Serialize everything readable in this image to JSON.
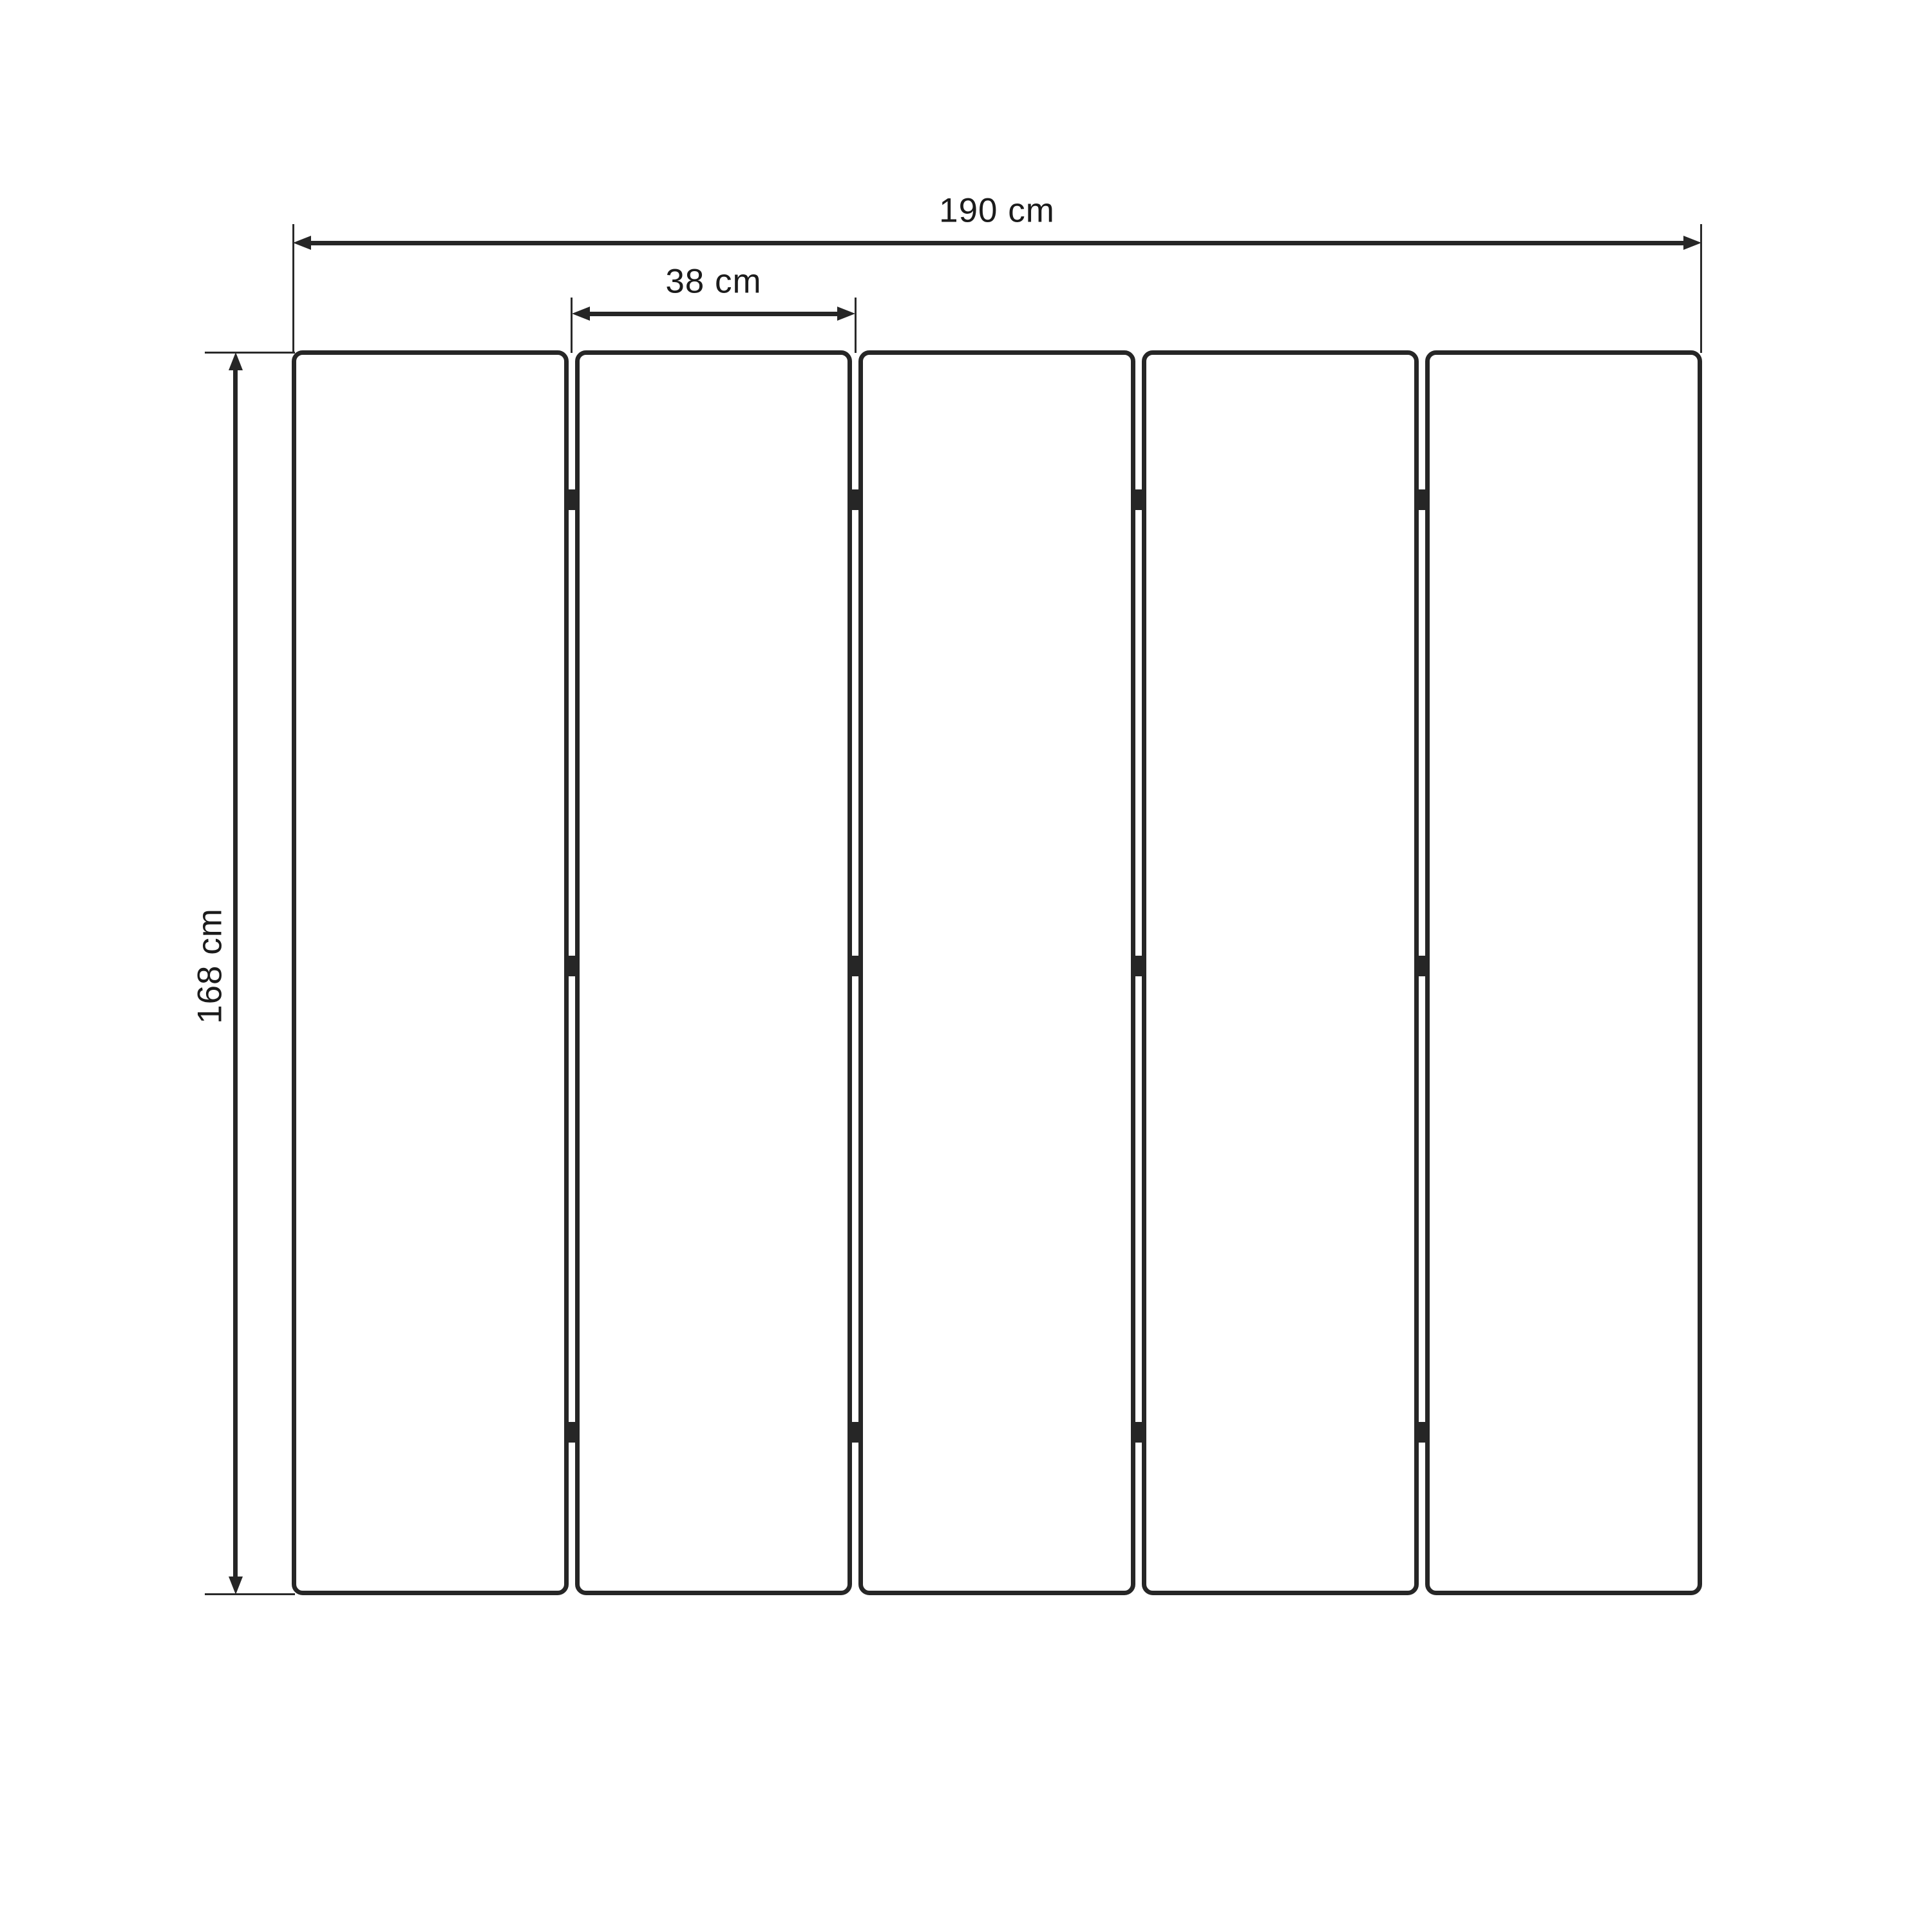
{
  "diagram": {
    "kind": "dimension-drawing",
    "subject": "five-panel-folding-screen",
    "dimensions": {
      "total_width": {
        "label": "190 cm",
        "value": 190,
        "unit": "cm"
      },
      "panel_width": {
        "label": "38 cm",
        "value": 38,
        "unit": "cm"
      },
      "height": {
        "label": "168 cm",
        "value": 168,
        "unit": "cm"
      }
    },
    "panel_count": 5,
    "hinge_gaps": 4,
    "hinges_per_gap": 3,
    "colors": {
      "stroke": "#262626",
      "text": "#1b1b1b",
      "background": "#ffffff"
    }
  }
}
